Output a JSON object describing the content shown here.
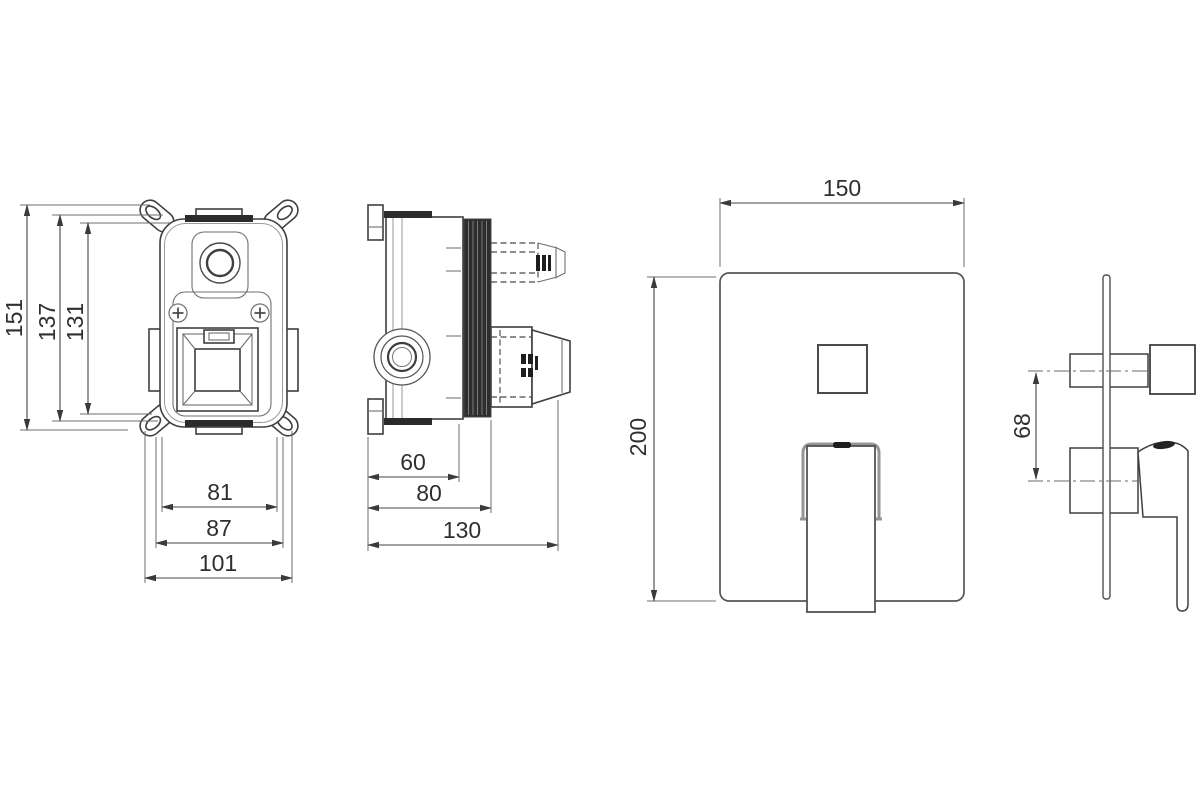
{
  "document": {
    "type": "technical-drawing",
    "subject": "Concealed shower mixer valve - installation dimension drawing",
    "units": "mm",
    "background_color": "#ffffff",
    "line_color": "#3f3f3f",
    "dark_fill_color": "#2b2b2b"
  },
  "views": {
    "valve_front": {
      "label": "rough-in valve front view",
      "dims": {
        "overall_height": "151",
        "body_height": "137",
        "inner_height": "131",
        "inner_width": "81",
        "body_width": "87",
        "overall_width": "101"
      }
    },
    "valve_side": {
      "label": "rough-in valve side view",
      "dims": {
        "flange_to_body": "60",
        "flange_to_thread": "80",
        "overall_depth": "130"
      }
    },
    "plate_front": {
      "label": "trim plate front view",
      "dims": {
        "width": "150",
        "height": "200"
      }
    },
    "trim_side": {
      "label": "trim side view",
      "dims": {
        "port_center_spacing": "68"
      }
    }
  }
}
